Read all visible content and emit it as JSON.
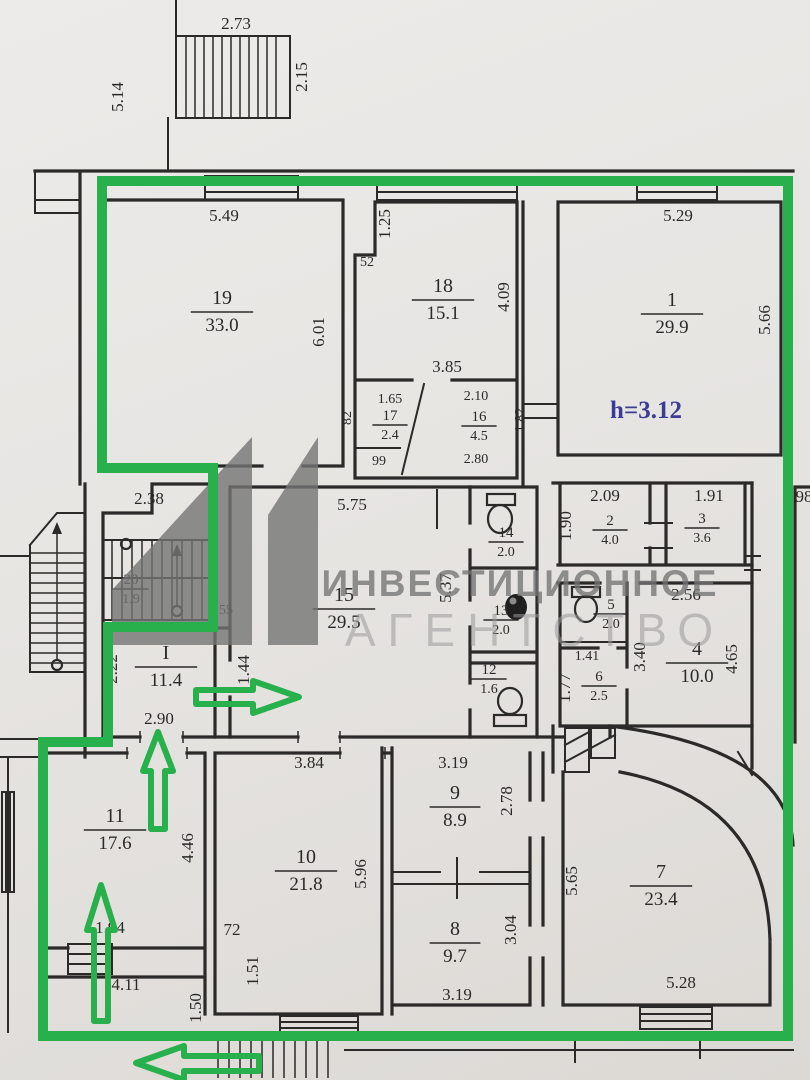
{
  "colors": {
    "ink": "#2b2a28",
    "green": "#27b04b",
    "blue": "#3c3c96",
    "wm_dark": "#747474",
    "wm_light": "#9a9a9a"
  },
  "watermark": {
    "line1": "ИНВЕСТИЦИОННОЕ",
    "line2": "АГЕНТСТВО",
    "logo": "A1-monogram"
  },
  "note": {
    "text": "h=3.12"
  },
  "plan": {
    "rooms": [
      {
        "n": "19",
        "a": "33.0",
        "x": 222,
        "y": 304
      },
      {
        "n": "18",
        "a": "15.1",
        "x": 443,
        "y": 292
      },
      {
        "n": "1",
        "a": "29.9",
        "x": 672,
        "y": 306
      },
      {
        "n": "17",
        "a": "2.4",
        "x": 390,
        "y": 420,
        "s": 1
      },
      {
        "n": "16",
        "a": "4.5",
        "x": 479,
        "y": 421,
        "s": 1
      },
      {
        "n": "20",
        "a": "1.9",
        "x": 131,
        "y": 584,
        "s": 1
      },
      {
        "n": "15",
        "a": "29.5",
        "x": 344,
        "y": 601
      },
      {
        "n": "I",
        "a": "11.4",
        "x": 166,
        "y": 659
      },
      {
        "n": "14",
        "a": "2.0",
        "x": 506,
        "y": 537,
        "s": 1
      },
      {
        "n": "13",
        "a": "2.0",
        "x": 501,
        "y": 615,
        "s": 1
      },
      {
        "n": "12",
        "a": "1.6",
        "x": 489,
        "y": 674,
        "s": 1
      },
      {
        "n": "2",
        "a": "4.0",
        "x": 610,
        "y": 525,
        "s": 1
      },
      {
        "n": "3",
        "a": "3.6",
        "x": 702,
        "y": 523,
        "s": 1
      },
      {
        "n": "5",
        "a": "2.0",
        "x": 611,
        "y": 609,
        "s": 1
      },
      {
        "n": "6",
        "a": "2.5",
        "x": 599,
        "y": 681,
        "s": 1
      },
      {
        "n": "4",
        "a": "10.0",
        "x": 697,
        "y": 655
      },
      {
        "n": "11",
        "a": "17.6",
        "x": 115,
        "y": 822
      },
      {
        "n": "10",
        "a": "21.8",
        "x": 306,
        "y": 863
      },
      {
        "n": "9",
        "a": "8.9",
        "x": 455,
        "y": 799
      },
      {
        "n": "8",
        "a": "9.7",
        "x": 455,
        "y": 935
      },
      {
        "n": "7",
        "a": "23.4",
        "x": 661,
        "y": 878
      }
    ],
    "dimensions": [
      {
        "t": "2.73",
        "x": 236,
        "y": 29
      },
      {
        "t": "2.15",
        "x": 307,
        "y": 77,
        "v": 1
      },
      {
        "t": "5.14",
        "x": 123,
        "y": 97,
        "v": 1
      },
      {
        "t": "5.49",
        "x": 224,
        "y": 221
      },
      {
        "t": "6.01",
        "x": 324,
        "y": 332,
        "v": 1
      },
      {
        "t": "1.25",
        "x": 390,
        "y": 224,
        "v": 1
      },
      {
        "t": "52",
        "x": 367,
        "y": 266,
        "s": 1
      },
      {
        "t": "4.09",
        "x": 509,
        "y": 297,
        "v": 1
      },
      {
        "t": "3.85",
        "x": 447,
        "y": 372
      },
      {
        "t": "5.29",
        "x": 678,
        "y": 221
      },
      {
        "t": "5.66",
        "x": 770,
        "y": 320,
        "v": 1
      },
      {
        "t": "1.65",
        "x": 390,
        "y": 403,
        "s": 1
      },
      {
        "t": "99",
        "x": 379,
        "y": 465,
        "s": 1
      },
      {
        "t": "82",
        "x": 351,
        "y": 418,
        "v": 1,
        "s": 1
      },
      {
        "t": "2.10",
        "x": 476,
        "y": 400,
        "s": 1
      },
      {
        "t": "2.80",
        "x": 476,
        "y": 463,
        "s": 1
      },
      {
        "t": "1.82",
        "x": 524,
        "y": 420,
        "v": 1,
        "s": 1
      },
      {
        "t": "2.38",
        "x": 149,
        "y": 504
      },
      {
        "t": "55",
        "x": 226,
        "y": 614,
        "s": 1
      },
      {
        "t": "5.75",
        "x": 352,
        "y": 510
      },
      {
        "t": "5.37",
        "x": 451,
        "y": 588,
        "v": 1
      },
      {
        "t": "2.22",
        "x": 117,
        "y": 669,
        "v": 1
      },
      {
        "t": "1.44",
        "x": 249,
        "y": 670,
        "v": 1
      },
      {
        "t": "2.90",
        "x": 159,
        "y": 724
      },
      {
        "t": "2.09",
        "x": 605,
        "y": 501
      },
      {
        "t": "1.90",
        "x": 571,
        "y": 526,
        "v": 1
      },
      {
        "t": "1.91",
        "x": 709,
        "y": 501
      },
      {
        "t": "2.56",
        "x": 686,
        "y": 600
      },
      {
        "t": "1.41",
        "x": 587,
        "y": 660,
        "s": 1
      },
      {
        "t": "1.77",
        "x": 570,
        "y": 688,
        "v": 1
      },
      {
        "t": "3.40",
        "x": 645,
        "y": 657,
        "v": 1
      },
      {
        "t": "4.65",
        "x": 737,
        "y": 659,
        "v": 1
      },
      {
        "t": "98",
        "x": 804,
        "y": 502
      },
      {
        "t": "3.84",
        "x": 309,
        "y": 768
      },
      {
        "t": "3.19",
        "x": 453,
        "y": 768
      },
      {
        "t": "2.78",
        "x": 512,
        "y": 801,
        "v": 1
      },
      {
        "t": "4.46",
        "x": 193,
        "y": 848,
        "v": 1
      },
      {
        "t": "5.96",
        "x": 366,
        "y": 874,
        "v": 1
      },
      {
        "t": "3.04",
        "x": 516,
        "y": 930,
        "v": 1
      },
      {
        "t": "3.19",
        "x": 457,
        "y": 1000
      },
      {
        "t": "1.94",
        "x": 110,
        "y": 933
      },
      {
        "t": "72",
        "x": 232,
        "y": 935
      },
      {
        "t": "4.11",
        "x": 126,
        "y": 990
      },
      {
        "t": "1.50",
        "x": 201,
        "y": 1008,
        "v": 1
      },
      {
        "t": "1.51",
        "x": 258,
        "y": 971,
        "v": 1
      },
      {
        "t": "5.65",
        "x": 577,
        "y": 881,
        "v": 1
      },
      {
        "t": "5.28",
        "x": 681,
        "y": 988
      }
    ]
  }
}
